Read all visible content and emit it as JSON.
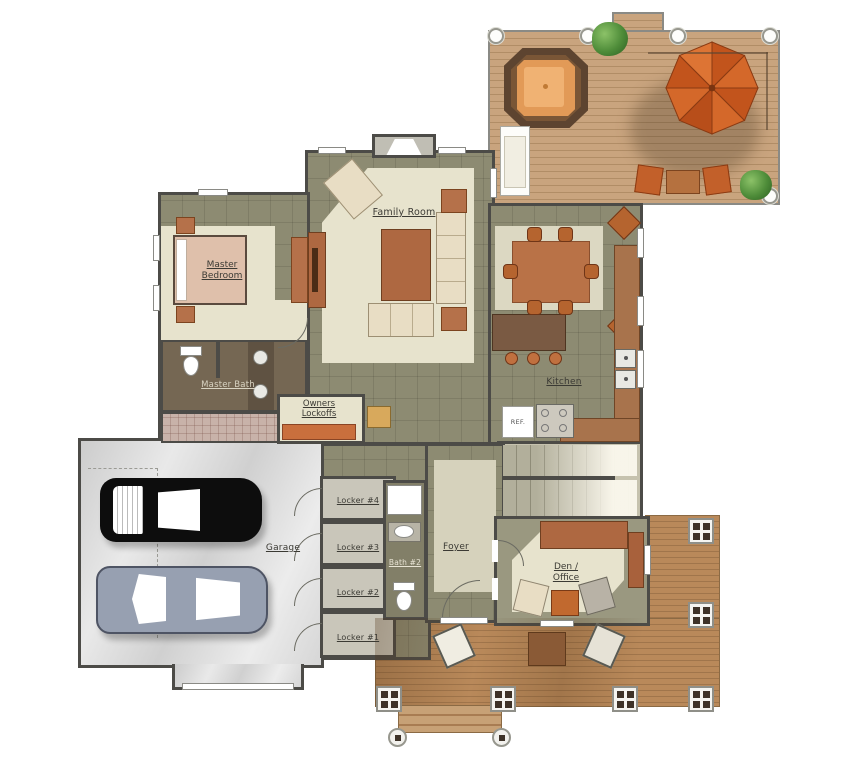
{
  "type": "architectural-first-floor-plan",
  "labels": {
    "family_room": "Family Room",
    "master_bedroom_line1": "Master",
    "master_bedroom_line2": "Bedroom",
    "master_bath": "Master Bath",
    "owners_lockoffs_line1": "Owners",
    "owners_lockoffs_line2": "Lockoffs",
    "kitchen": "Kitchen",
    "refrigerator": "REF.",
    "garage": "Garage",
    "locker_4": "Locker #4",
    "locker_3": "Locker #3",
    "locker_2": "Locker #2",
    "locker_1": "Locker #1",
    "bath_2": "Bath #2",
    "foyer": "Foyer",
    "den_office_line1": "Den /",
    "den_office_line2": "Office"
  },
  "palette": {
    "wall": "#4c4b47",
    "label": "#3b3a34",
    "deck_wood": "#c9a47e",
    "deck_line": "#b18d66",
    "porch_wood": "#b9895a",
    "porch_line": "#a0754b",
    "tile_olive": "#8d8b72",
    "carpet": "#e7e3cd",
    "rug": "#d6d2bc",
    "garage_floor": "#dbdbdb",
    "bath_floor": "#756753",
    "tile_pink": "#c8b2a9",
    "stair_floor": "#c6c2ae",
    "umbrella_dark": "#c2541c",
    "umbrella_light": "#d4682a",
    "hot_tub_rim": "#5d4430",
    "hot_tub_water": "#e29a57",
    "furn_brown": "#ae6841",
    "furn_dark": "#7a5a43",
    "cream": "#e8ddc4",
    "bed": "#dfc0ab",
    "cabinet_orange": "#c96f3d",
    "car_black": "#0d0d0d",
    "car_gray": "#97a0b1",
    "plant_green": "#4e8c39"
  }
}
